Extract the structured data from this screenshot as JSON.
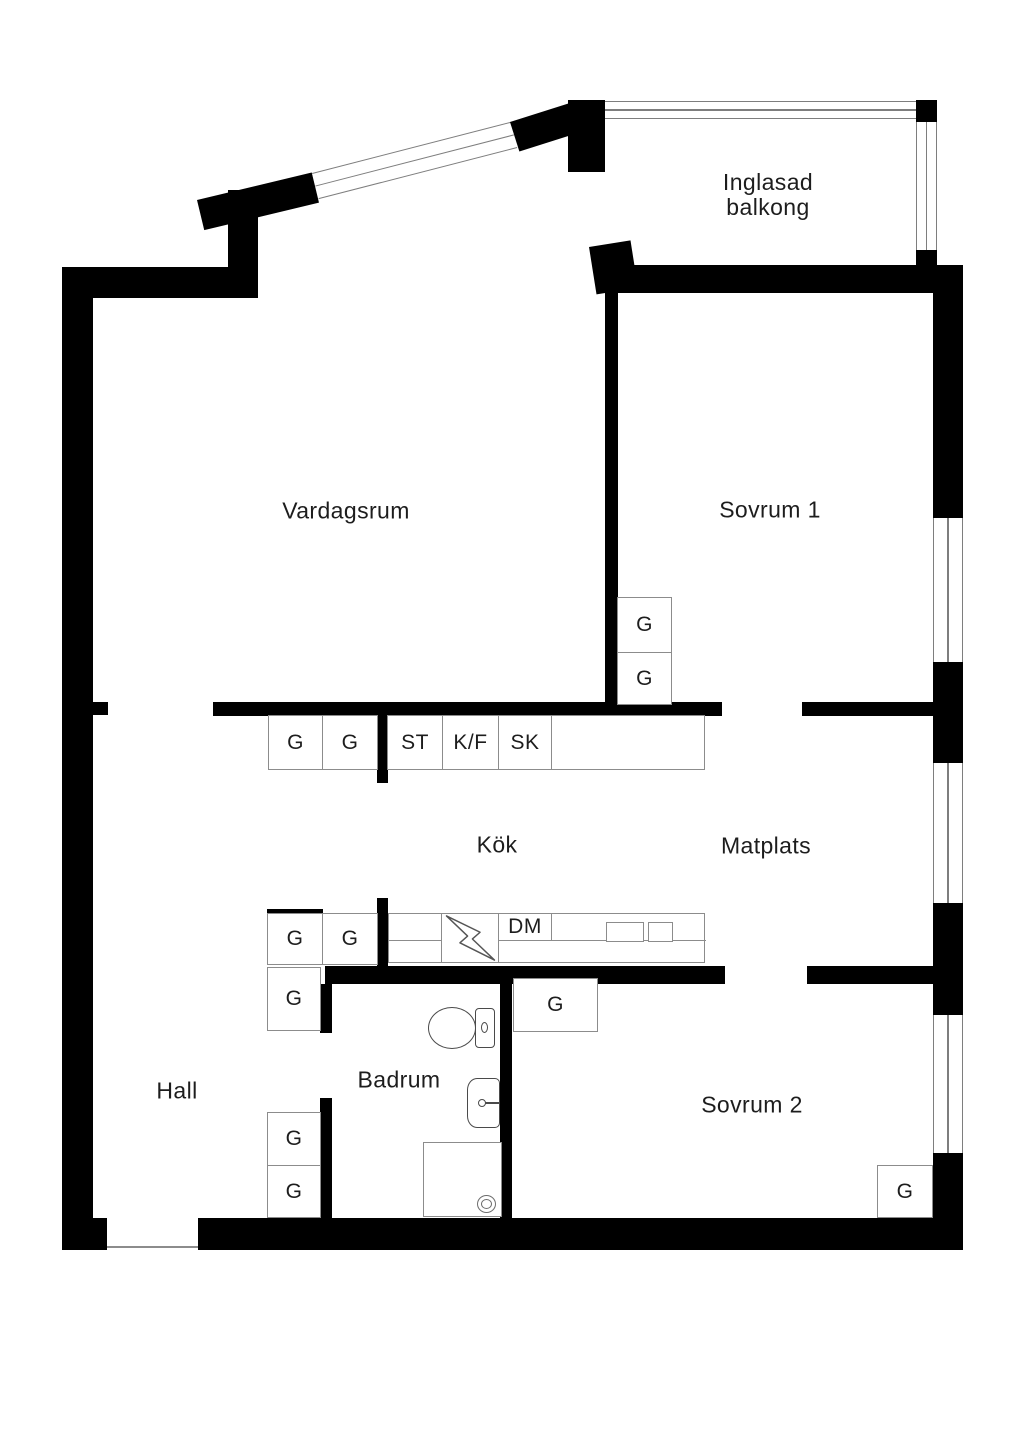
{
  "colors": {
    "wall": "#000000",
    "thin_line": "#7e7e7e",
    "cabinet_line": "#8c8c8c",
    "fixture_line": "#4a4a4a",
    "text": "#1d1d1d",
    "background": "#ffffff"
  },
  "rooms": {
    "balcony": {
      "line1": "Inglasad",
      "line2": "balkong"
    },
    "living_room": {
      "label": "Vardagsrum"
    },
    "bedroom1": {
      "label": "Sovrum 1"
    },
    "kitchen": {
      "label": "Kök"
    },
    "dining": {
      "label": "Matplats"
    },
    "hall": {
      "label": "Hall"
    },
    "bathroom": {
      "label": "Badrum"
    },
    "bedroom2": {
      "label": "Sovrum 2"
    }
  },
  "cabinets": {
    "kitchen_upper": [
      {
        "label": "G"
      },
      {
        "label": "G"
      },
      {
        "label": "ST"
      },
      {
        "label": "K/F"
      },
      {
        "label": "SK"
      },
      {
        "label": ""
      }
    ],
    "bedroom1_closets": [
      {
        "label": "G"
      },
      {
        "label": "G"
      }
    ],
    "kitchen_lower": [
      {
        "label": "G"
      },
      {
        "label": "G"
      }
    ],
    "counter": {
      "dishwasher_label": "DM"
    },
    "hall_top_closet": {
      "label": "G"
    },
    "bedroom2_entry_closet": {
      "label": "G"
    },
    "hall_closets": [
      {
        "label": "G"
      },
      {
        "label": "G"
      }
    ],
    "bedroom2_corner_closet": {
      "label": "G"
    }
  },
  "icons": {
    "stove": "lightning-bolt-icon",
    "toilet": "toilet-plan-icon",
    "washbasin": "washbasin-plan-icon",
    "shower_drain": "drain-icon",
    "kitchen_sink": "double-basin-sink-icon"
  }
}
